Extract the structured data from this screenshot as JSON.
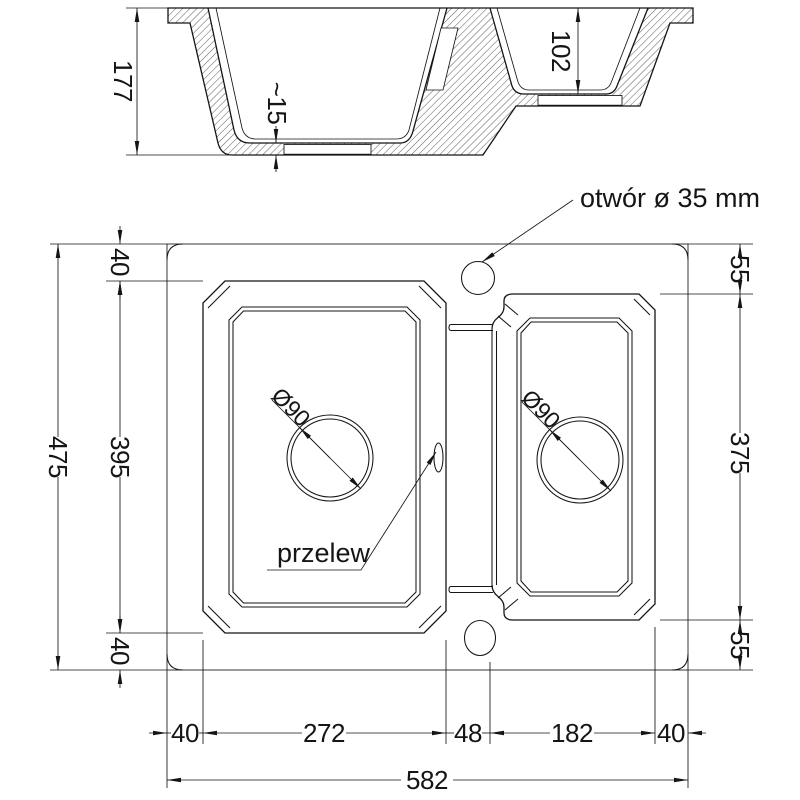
{
  "labels": {
    "hole": "otwór ø 35 mm",
    "overflow": "przelew",
    "drain_left": "Ø90",
    "drain_right": "Ø90"
  },
  "section": {
    "total": "177",
    "step": "~15",
    "bowl2": "102"
  },
  "left": {
    "top": "40",
    "bowl": "395",
    "bottom": "40",
    "total": "475"
  },
  "right": {
    "top": "55",
    "bowl": "375",
    "bottom": "55"
  },
  "bottom": {
    "m_left": "40",
    "bowl_left": "272",
    "divider": "48",
    "bowl_right": "182",
    "m_right": "40",
    "total": "582"
  },
  "colors": {
    "line": "#151515",
    "background": "#ffffff"
  }
}
